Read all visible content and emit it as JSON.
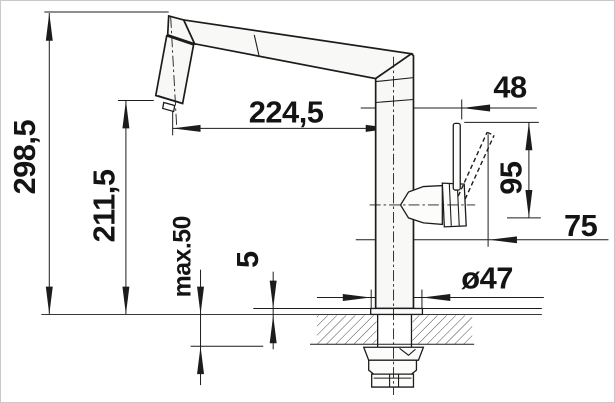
{
  "drawing": {
    "title": "Kitchen faucet dimensional drawing (side view)",
    "units": "mm",
    "colors": {
      "line": "#1c1c1c",
      "part_fill": "#f8f8f6",
      "background": "#ffffff"
    },
    "dimensions": {
      "total_height": "298,5",
      "outlet_height": "211,5",
      "max_mounting_thickness": "max.50",
      "base_plate_height": "5",
      "spout_reach": "224,5",
      "lever_offset": "48",
      "lever_height": "95",
      "handle_reach": "75",
      "base_diameter": "ø47"
    }
  }
}
